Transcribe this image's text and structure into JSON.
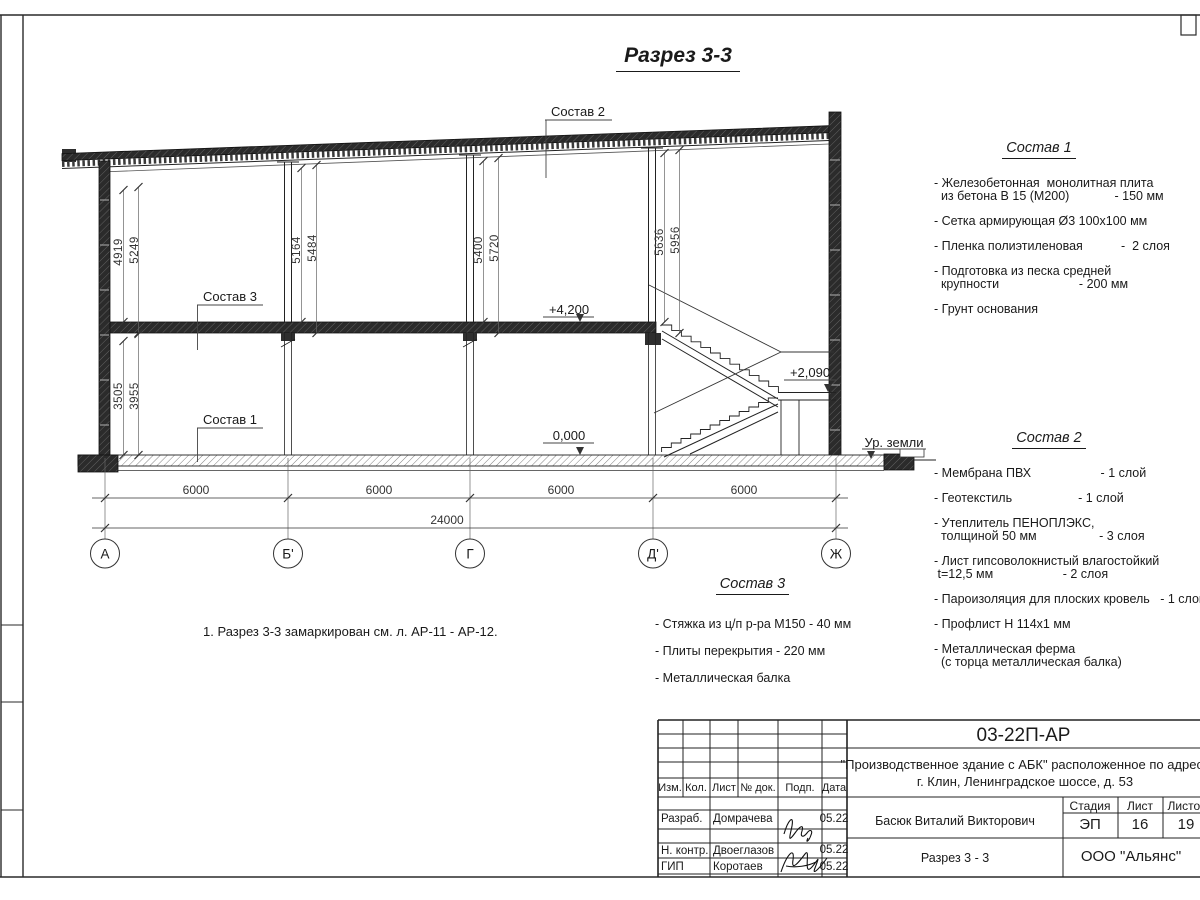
{
  "title": "Разрез 3-3",
  "note": "1. Разрез 3-3 замаркирован см. л. АР-11 - АР-12.",
  "drawing": {
    "axis_labels": [
      "А",
      "Б'",
      "Г",
      "Д'",
      "Ж"
    ],
    "span_dims": [
      "6000",
      "6000",
      "6000",
      "6000"
    ],
    "total_dim": "24000",
    "left_dims_upper": [
      "4919",
      "5249"
    ],
    "left_dims_lower": [
      "3505",
      "3955"
    ],
    "col_dims_b": [
      "5164",
      "5484"
    ],
    "col_dims_g": [
      "5400",
      "5720"
    ],
    "col_dims_d": [
      "5636",
      "5956"
    ],
    "elevations": {
      "second_floor": "+4,200",
      "ground": "0,000",
      "landing": "+2,090",
      "ground_level": "Ур. земли"
    },
    "callouts": {
      "sostav1": "Состав 1",
      "sostav2": "Состав 2",
      "sostav3": "Состав 3"
    }
  },
  "sostav1": {
    "heading": "Состав 1",
    "lines": [
      "- Железобетонная  монолитная плита",
      "  из бетона В 15 (М200)             - 150 мм",
      "- Сетка армирующая Ø3 100х100 мм",
      "- Пленка полиэтиленовая           -  2 слоя",
      "- Подготовка из песка средней",
      "  крупности                       - 200 мм",
      "- Грунт основания"
    ]
  },
  "sostav2": {
    "heading": "Состав 2",
    "lines": [
      "- Мембрана ПВХ                    - 1 слой",
      "- Геотекстиль                   - 1 слой",
      "- Утеплитель ПЕНОПЛЭКС,",
      "  толщиной 50 мм                  - 3 слоя",
      "- Лист гипсоволокнистый влагостойкий",
      " t=12,5 мм                    - 2 слоя",
      "- Пароизоляция для плоских кровель   - 1 слой",
      "- Профлист Н 114х1 мм",
      "- Металлическая ферма",
      "  (с торца металлическая балка)"
    ]
  },
  "sostav3": {
    "heading": "Состав 3",
    "lines": [
      "- Стяжка из ц/п р-ра М150 - 40 мм",
      "- Плиты перекрытия - 220 мм",
      "- Металлическая балка"
    ]
  },
  "titleblock": {
    "code": "03-22П-АР",
    "object_line1": "\"Производственное здание с АБК\" расположенное по адресу",
    "object_line2": "г. Клин, Ленинградское шоссе, д. 53",
    "cols": {
      "izm": "Изм.",
      "kol": "Кол.",
      "list": "Лист",
      "doc": "№ док.",
      "podp": "Подп.",
      "data": "Дата"
    },
    "rows": [
      {
        "role": "Разраб.",
        "name": "Домрачева",
        "date": "05.22"
      },
      {
        "role": "Н. контр.",
        "name": "Двоеглазов",
        "date": "05.22"
      },
      {
        "role": "ГИП",
        "name": "Коротаев",
        "date": "05.22"
      }
    ],
    "engineer": "Басюк Виталий Викторович",
    "stage_label": "Стадия",
    "sheet_label": "Лист",
    "sheets_label": "Листов",
    "stage": "ЭП",
    "sheet": "16",
    "sheets": "19",
    "doc_title": "Разрез 3 - 3",
    "company": "ООО \"Альянс\""
  }
}
